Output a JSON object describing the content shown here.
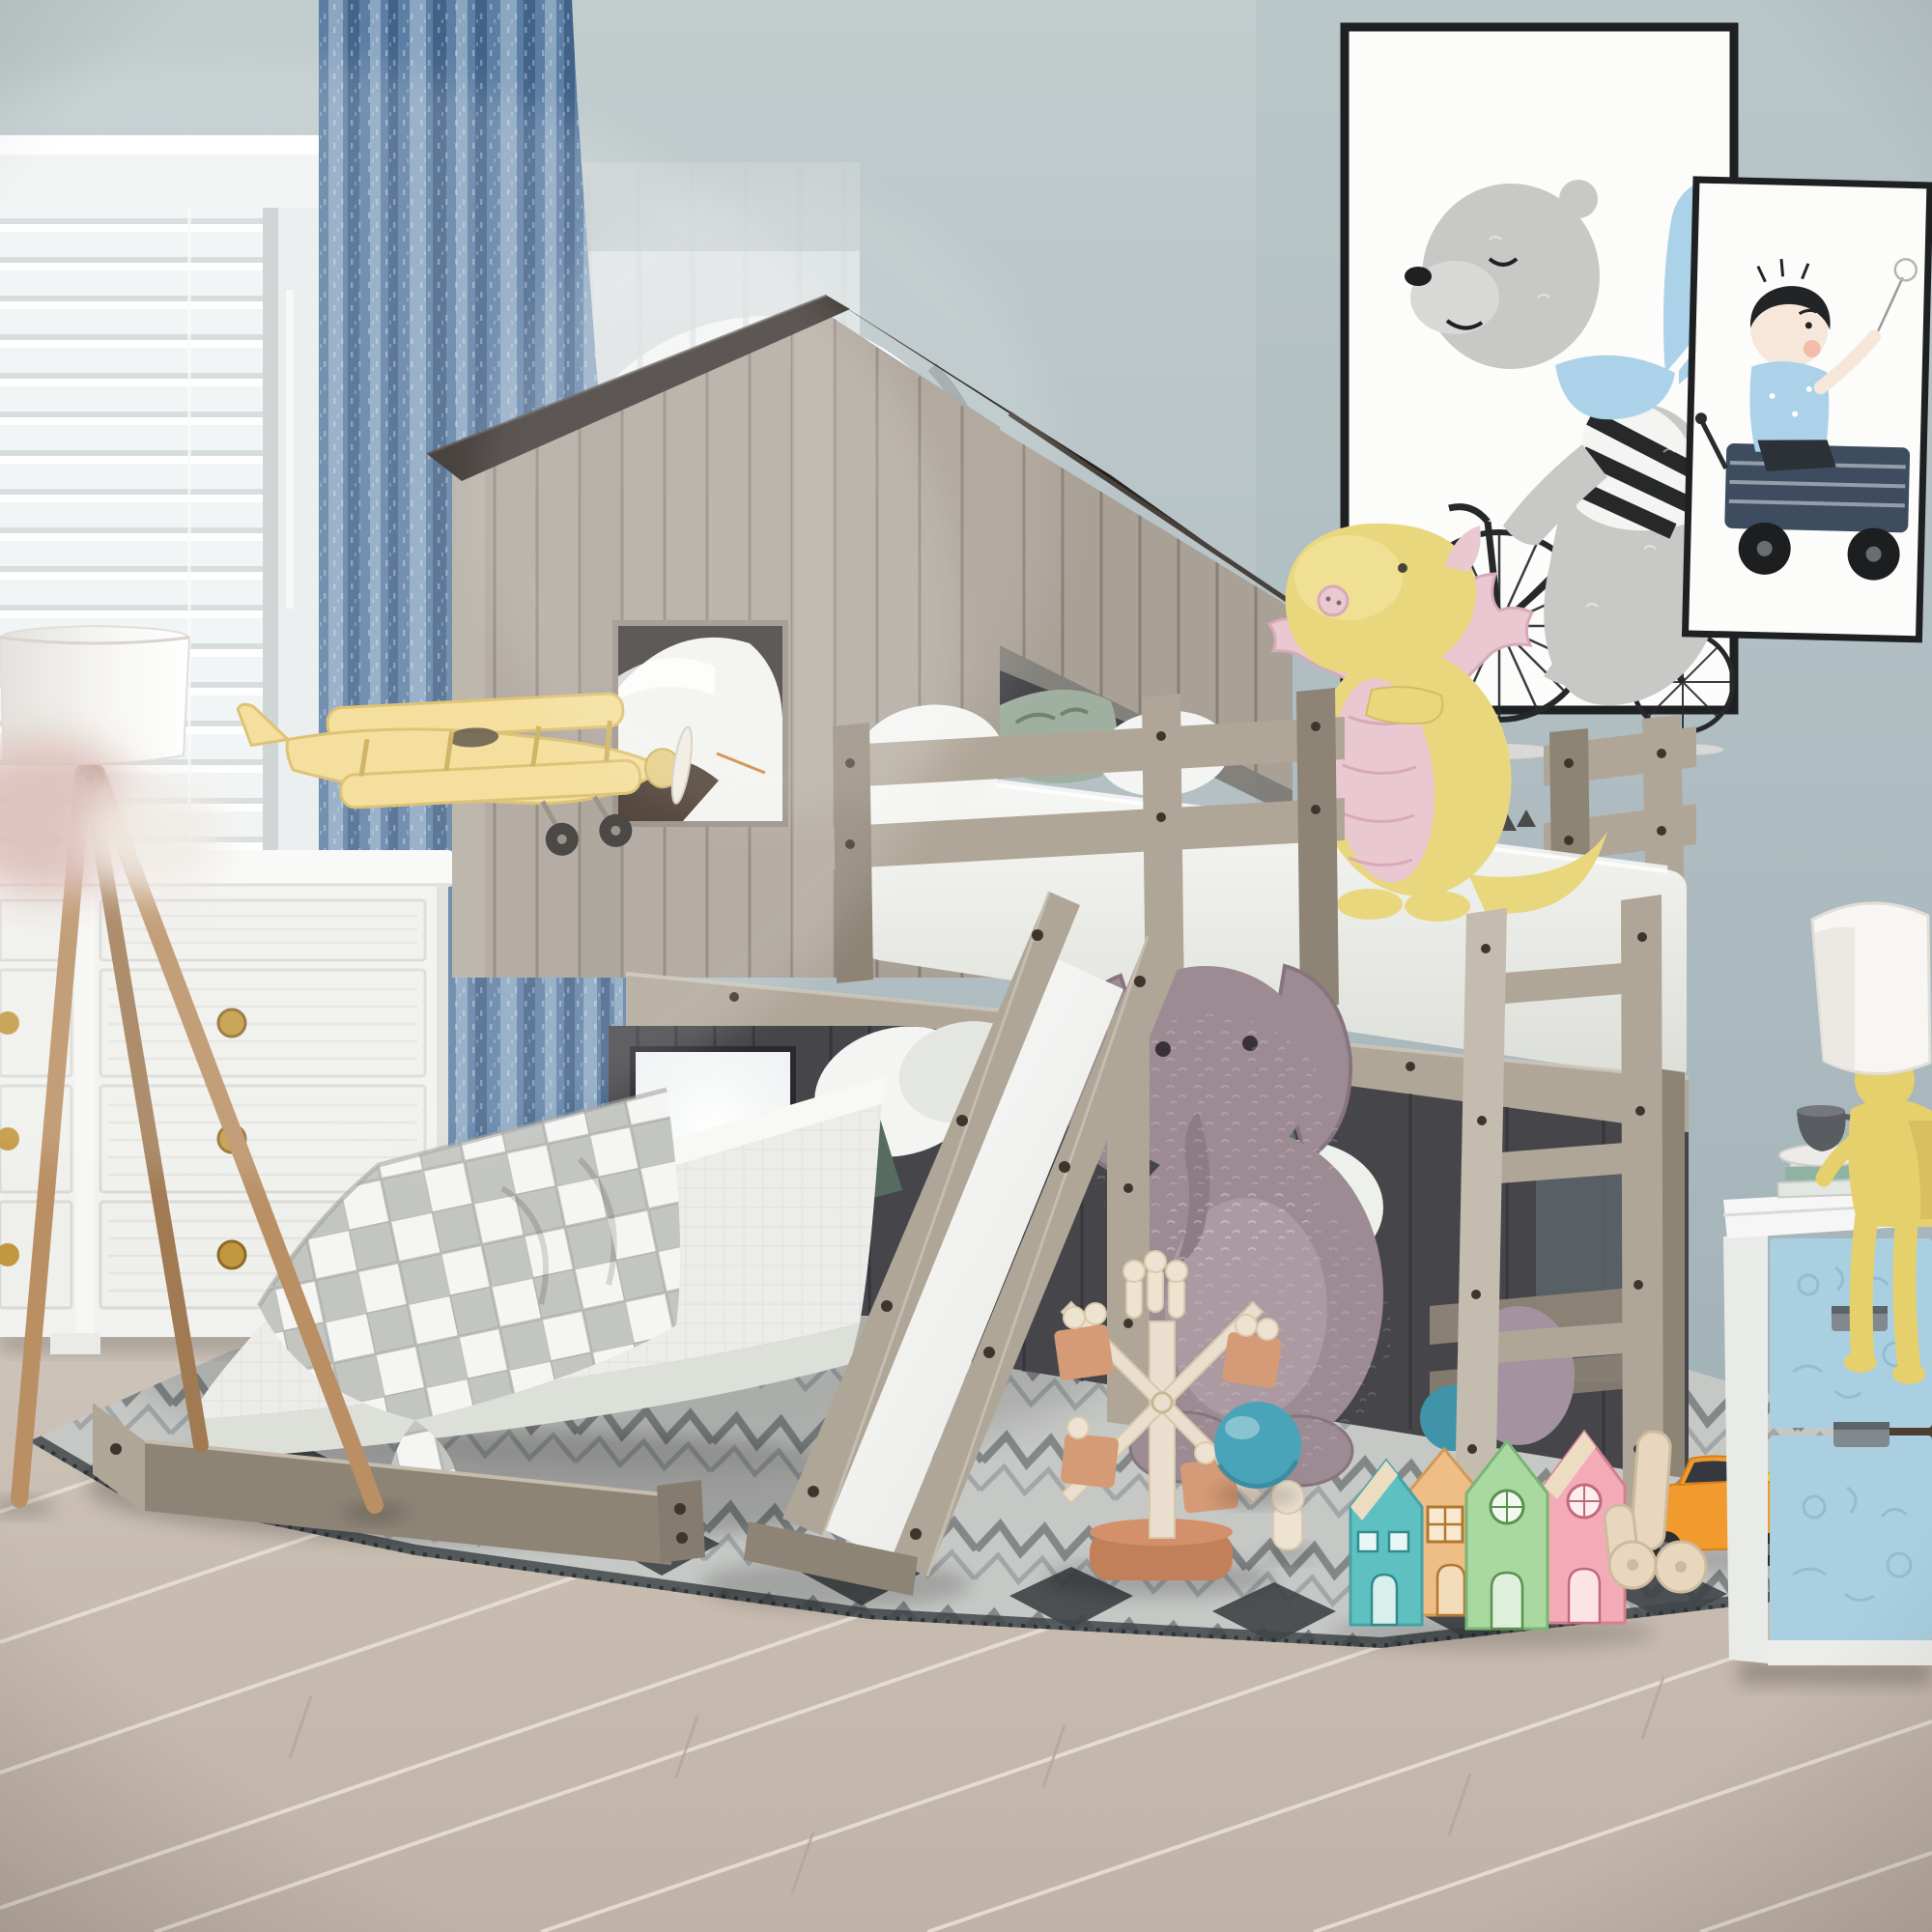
{
  "scene": {
    "type": "product-photo",
    "description": "Kids bedroom with a rustic gray house-shaped twin-over-full bunk loft bed featuring a dark plank roof, playhouse windows, guardrails, a ladder, and a white slide; decorated with plush toys, wooden toys, framed art, a dresser, tripod lamp and nightstand."
  },
  "palette": {
    "wall": "#b7c3c6",
    "archGlow": "#ffffff",
    "sheer": "#edf0f0",
    "windowFrame": "#f2f4f4",
    "curtain": "#5c7ea4",
    "curtainHi": "#93adc7",
    "curtainLo": "#3d5c81",
    "roof": "#2b2420",
    "plank": "#a9a096",
    "plankHi": "#bcb4a9",
    "plankLo": "#8f867c",
    "panel": "#46464a",
    "drift": "#b0a698",
    "driftHi": "#c4bcae",
    "driftLo": "#8e8476",
    "screw": "#3e352c",
    "mattress": "#f4f5f2",
    "bedding": "#ecedea",
    "pillowGreen": "#566c60",
    "pillowLeaf": "#9fb0a0",
    "frame": "#1e2022",
    "canvas": "#fcfcfa",
    "artGray": "#c8c8c6",
    "artBlue": "#abd2e9",
    "artNavy": "#3e4c60",
    "artInk": "#26282a",
    "skin": "#f6e7da",
    "dragon": "#e9d77e",
    "dragonPink": "#eac8d1",
    "elephant": "#9d8b94",
    "ballBlue": "#4aa4b9",
    "wmWood": "#eadfce",
    "wmBlock": "#d59b76",
    "wmBase": "#c2805a",
    "peg": "#eee3d0",
    "houseTeal": "#5fc0c2",
    "houseTan": "#eebe86",
    "houseGreen": "#a9d8a1",
    "housePink": "#f3acb7",
    "houseWood": "#ecdcc2",
    "carOrange": "#f19a2d",
    "carYellow": "#ead72e",
    "toyWood": "#e8d7be",
    "nsBlue": "#a9cfe0",
    "nsWhite": "#f5f6f5",
    "nsHandle": "#82898e",
    "lampWood": "#b98f63",
    "lampShade": "#f7f6f2",
    "knob": "#c2973f",
    "floor": "#c9beb3",
    "floorLine": "#ece5dc",
    "baseboard": "#4d3e31",
    "rug": "#c6c8c6",
    "rugMid": "#8f9495",
    "rugDark": "#3e4345",
    "planeYellow": "#f3da8e",
    "cup": "#595d61",
    "figYellow": "#e6d06c"
  },
  "objects": {
    "room": {
      "label": "Kids bedroom scene"
    },
    "window": {
      "label": "Window with white venetian blinds"
    },
    "curtain": {
      "label": "Blue speckled curtain"
    },
    "sheer": {
      "label": "Sheer curtain over bright arched alcove"
    },
    "artBear": {
      "label": "Framed art: bear with blue scarf riding a bicycle"
    },
    "artBoy": {
      "label": "Framed art: boy riding in a navy wagon"
    },
    "bed": {
      "label": "House-shaped bunk loft bed in weathered gray wood"
    },
    "roof": {
      "label": "Dark wood plank roof"
    },
    "gableWindow": {
      "label": "Playhouse window with white pillow"
    },
    "loft": {
      "label": "Top bunk with mattress, pillows and guardrails"
    },
    "dragon": {
      "label": "Yellow and pink dragon plush"
    },
    "ladder": {
      "label": "Wooden ladder"
    },
    "slide": {
      "label": "Wooden slide with white surface"
    },
    "lowerBed": {
      "label": "Bottom full bed with white bedding and plaid throw"
    },
    "lowerWindow": {
      "label": "Lower playhouse window with daylight"
    },
    "elephant": {
      "label": "Mauve plush elephant"
    },
    "windmill": {
      "label": "Wooden windmill toy with peg dolls"
    },
    "pegDoll": {
      "label": "Wooden peg doll"
    },
    "houses": {
      "label": "Pastel wooden toy houses"
    },
    "cars": {
      "label": "Orange and yellow toy cars"
    },
    "figureToy": {
      "label": "Natural wood figure toy"
    },
    "ball": {
      "label": "Blue ball"
    },
    "rug": {
      "label": "Gray geometric rug"
    },
    "floor": {
      "label": "Light oak plank floor"
    },
    "dresser": {
      "label": "White dresser with gold knobs"
    },
    "lamp": {
      "label": "Wood tripod floor lamp with white drum shade"
    },
    "plane": {
      "label": "Yellow toy biplane"
    },
    "nightstand": {
      "label": "White nightstand with blue embossed drawers"
    },
    "figLamp": {
      "label": "Yellow figure table lamp with white shade"
    },
    "books": {
      "label": "Stacked books"
    },
    "cup": {
      "label": "Gray cup on saucer"
    }
  }
}
